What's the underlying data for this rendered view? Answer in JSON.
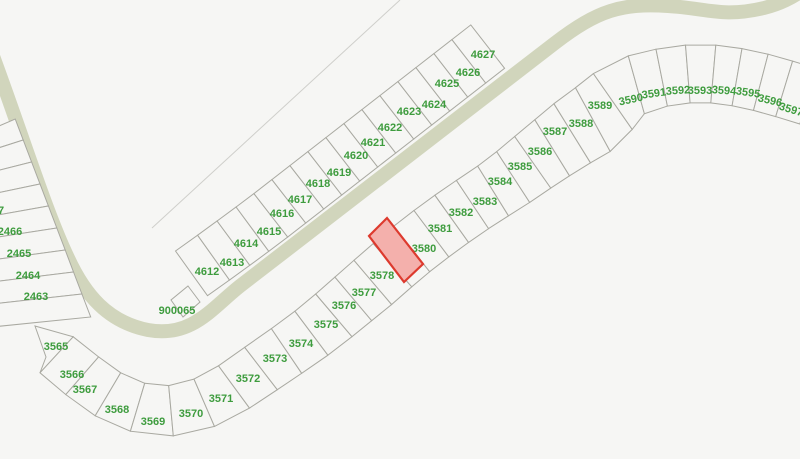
{
  "map": {
    "colors": {
      "background": "#f6f6f4",
      "road": "#d1d5bc",
      "parcel_line": "#a9a9a1",
      "parcel_fill": "#f6f6f4",
      "label_green": "#3e9c3e",
      "faint_line": "#cfcfcb"
    },
    "roads": [
      {
        "name": "main-road",
        "d": "M -10,48 C 20,128 45,210 68,258 C 85,295 108,322 148,330 C 192,338 212,308 240,286 L 555,43 C 598,10 622,3 668,6 C 706,8 722,18 764,8 C 780,4 792,-2 806,-12",
        "width": 14
      }
    ],
    "boundary_lines": [
      {
        "name": "section-line",
        "x1": 152,
        "y1": 228,
        "x2": 400,
        "y2": 0
      }
    ],
    "strips": [
      {
        "name": "parcel-strip-3565-3597",
        "fields": [
          "id",
          "cx",
          "cy",
          "depth_left",
          "depth_right",
          "label_x",
          "label_y",
          "label_rotation"
        ],
        "start_cap": [
          [
            35,
            326
          ],
          [
            46,
            357
          ]
        ],
        "parcels": [
          [
            "3565",
            48,
            338,
            16,
            32,
            56,
            347,
            0
          ],
          [
            "3566",
            74,
            362,
            20,
            30,
            72,
            375,
            0
          ],
          [
            "3567",
            97,
            382,
            20,
            30,
            85,
            390,
            0
          ],
          [
            "3568",
            124,
            398,
            20,
            30,
            117,
            410,
            0
          ],
          [
            "3569",
            154,
            407,
            20,
            30,
            153,
            422,
            0
          ],
          [
            "3570",
            187,
            404,
            20,
            31,
            191,
            414,
            0
          ],
          [
            "3571",
            217,
            391,
            20,
            32,
            221,
            399,
            0
          ],
          [
            "3572",
            243,
            372,
            19,
            34,
            248,
            379,
            0
          ],
          [
            "3573",
            269,
            352,
            18,
            36,
            275,
            359,
            0
          ],
          [
            "3574",
            294,
            335,
            18,
            36,
            301,
            344,
            0
          ],
          [
            "3575",
            318,
            317,
            19,
            37,
            326,
            325,
            0
          ],
          [
            "3576",
            338,
            300,
            19,
            37,
            344,
            306,
            0
          ],
          [
            "3577",
            357,
            284,
            20,
            38,
            364,
            293,
            0
          ],
          [
            "3578",
            377,
            267,
            20,
            38,
            382,
            276,
            0
          ],
          [
            "3579",
            396,
            250,
            20,
            38,
            399,
            256,
            0
          ],
          [
            "3580",
            416,
            234,
            20,
            38,
            424,
            249,
            0
          ],
          [
            "3581",
            436,
            219,
            20,
            38,
            440,
            229,
            0
          ],
          [
            "3582",
            457,
            204,
            20,
            38,
            461,
            213,
            0
          ],
          [
            "3583",
            478,
            190,
            20,
            38,
            485,
            202,
            0
          ],
          [
            "3584",
            499,
            177,
            21,
            38,
            500,
            182,
            0
          ],
          [
            "3585",
            519,
            164,
            24,
            38,
            520,
            167,
            0
          ],
          [
            "3586",
            539,
            150,
            26,
            38,
            540,
            152,
            0
          ],
          [
            "3587",
            560,
            137,
            30,
            38,
            555,
            132,
            0
          ],
          [
            "3588",
            581,
            124,
            33,
            38,
            581,
            124,
            0
          ],
          [
            "3589",
            603,
            112,
            36,
            38,
            600,
            106,
            0
          ],
          [
            "3590",
            626,
            96,
            38,
            24,
            631,
            100,
            -12
          ],
          [
            "3591",
            651,
            89,
            38,
            20,
            654,
            94,
            -8
          ],
          [
            "3592",
            676,
            84,
            38,
            20,
            678,
            91,
            -4
          ],
          [
            "3593",
            701,
            82,
            38,
            20,
            700,
            91,
            0
          ],
          [
            "3594",
            724,
            84,
            38,
            20,
            724,
            91,
            4
          ],
          [
            "3595",
            747,
            88,
            38,
            20,
            748,
            93,
            8
          ],
          [
            "3596",
            770,
            94,
            38,
            20,
            770,
            101,
            13
          ],
          [
            "3597",
            793,
            101,
            38,
            20,
            791,
            110,
            17
          ]
        ]
      },
      {
        "name": "parcel-strip-4612-4627",
        "fields": [
          "id",
          "cx",
          "cy",
          "depth_left",
          "depth_right",
          "label_x",
          "label_y",
          "label_rotation"
        ],
        "parcels": [
          [
            "4612",
            208,
            272,
            36,
            19,
            207,
            272,
            0
          ],
          [
            "4613",
            229,
            257,
            36,
            19,
            232,
            263,
            0
          ],
          [
            "4614",
            248,
            243,
            36,
            19,
            246,
            244,
            0
          ],
          [
            "4615",
            267,
            229,
            36,
            19,
            269,
            232,
            0
          ],
          [
            "4616",
            285,
            215,
            36,
            19,
            282,
            214,
            0
          ],
          [
            "4617",
            303,
            201,
            36,
            19,
            300,
            200,
            0
          ],
          [
            "4618",
            321,
            187,
            36,
            19,
            318,
            184,
            0
          ],
          [
            "4619",
            339,
            173,
            36,
            19,
            339,
            173,
            0
          ],
          [
            "4620",
            357,
            159,
            36,
            19,
            356,
            156,
            0
          ],
          [
            "4621",
            375,
            145,
            36,
            19,
            373,
            143,
            0
          ],
          [
            "4622",
            393,
            131,
            36,
            19,
            390,
            128,
            0
          ],
          [
            "4623",
            411,
            117,
            36,
            19,
            409,
            112,
            0
          ],
          [
            "4624",
            429,
            103,
            36,
            19,
            434,
            105,
            0
          ],
          [
            "4625",
            447,
            89,
            36,
            19,
            447,
            84,
            0
          ],
          [
            "4626",
            465,
            75,
            36,
            19,
            468,
            73,
            0
          ],
          [
            "4627",
            483,
            61,
            36,
            19,
            483,
            55,
            0
          ]
        ]
      }
    ],
    "left_column": {
      "name": "parcel-column-2463-2467",
      "separator_ys": [
        129,
        150,
        172,
        194,
        216,
        238,
        260,
        282,
        304,
        327
      ],
      "left_x": -8,
      "rise": 10,
      "road_slope": 0.381,
      "road_y0": 58,
      "road_inset": 8,
      "labels": [
        {
          "text": "67",
          "x": -2,
          "y": 211,
          "anchor": "start"
        },
        {
          "text": "2466",
          "x": 10,
          "y": 232
        },
        {
          "text": "2465",
          "x": 19,
          "y": 254
        },
        {
          "text": "2464",
          "x": 28,
          "y": 276
        },
        {
          "text": "2463",
          "x": 36,
          "y": 297
        }
      ]
    },
    "special_parcels": [
      {
        "id": "900065",
        "polygon": [
          [
            188,
            286
          ],
          [
            200,
            302
          ],
          [
            183,
            317
          ],
          [
            171,
            300
          ]
        ],
        "label": {
          "text": "900065",
          "x": 177,
          "y": 311
        }
      }
    ],
    "highlight": {
      "parcel_id": "3579",
      "fill": "#f4b0ac",
      "stroke": "#dd3a2e",
      "stroke_width": 2.2,
      "label_color": "#8a7518",
      "polygon": [
        [
          387,
          218
        ],
        [
          423,
          264
        ],
        [
          404,
          282
        ],
        [
          369,
          236
        ]
      ],
      "label": {
        "text": "3579",
        "x": 399,
        "y": 256
      }
    }
  }
}
